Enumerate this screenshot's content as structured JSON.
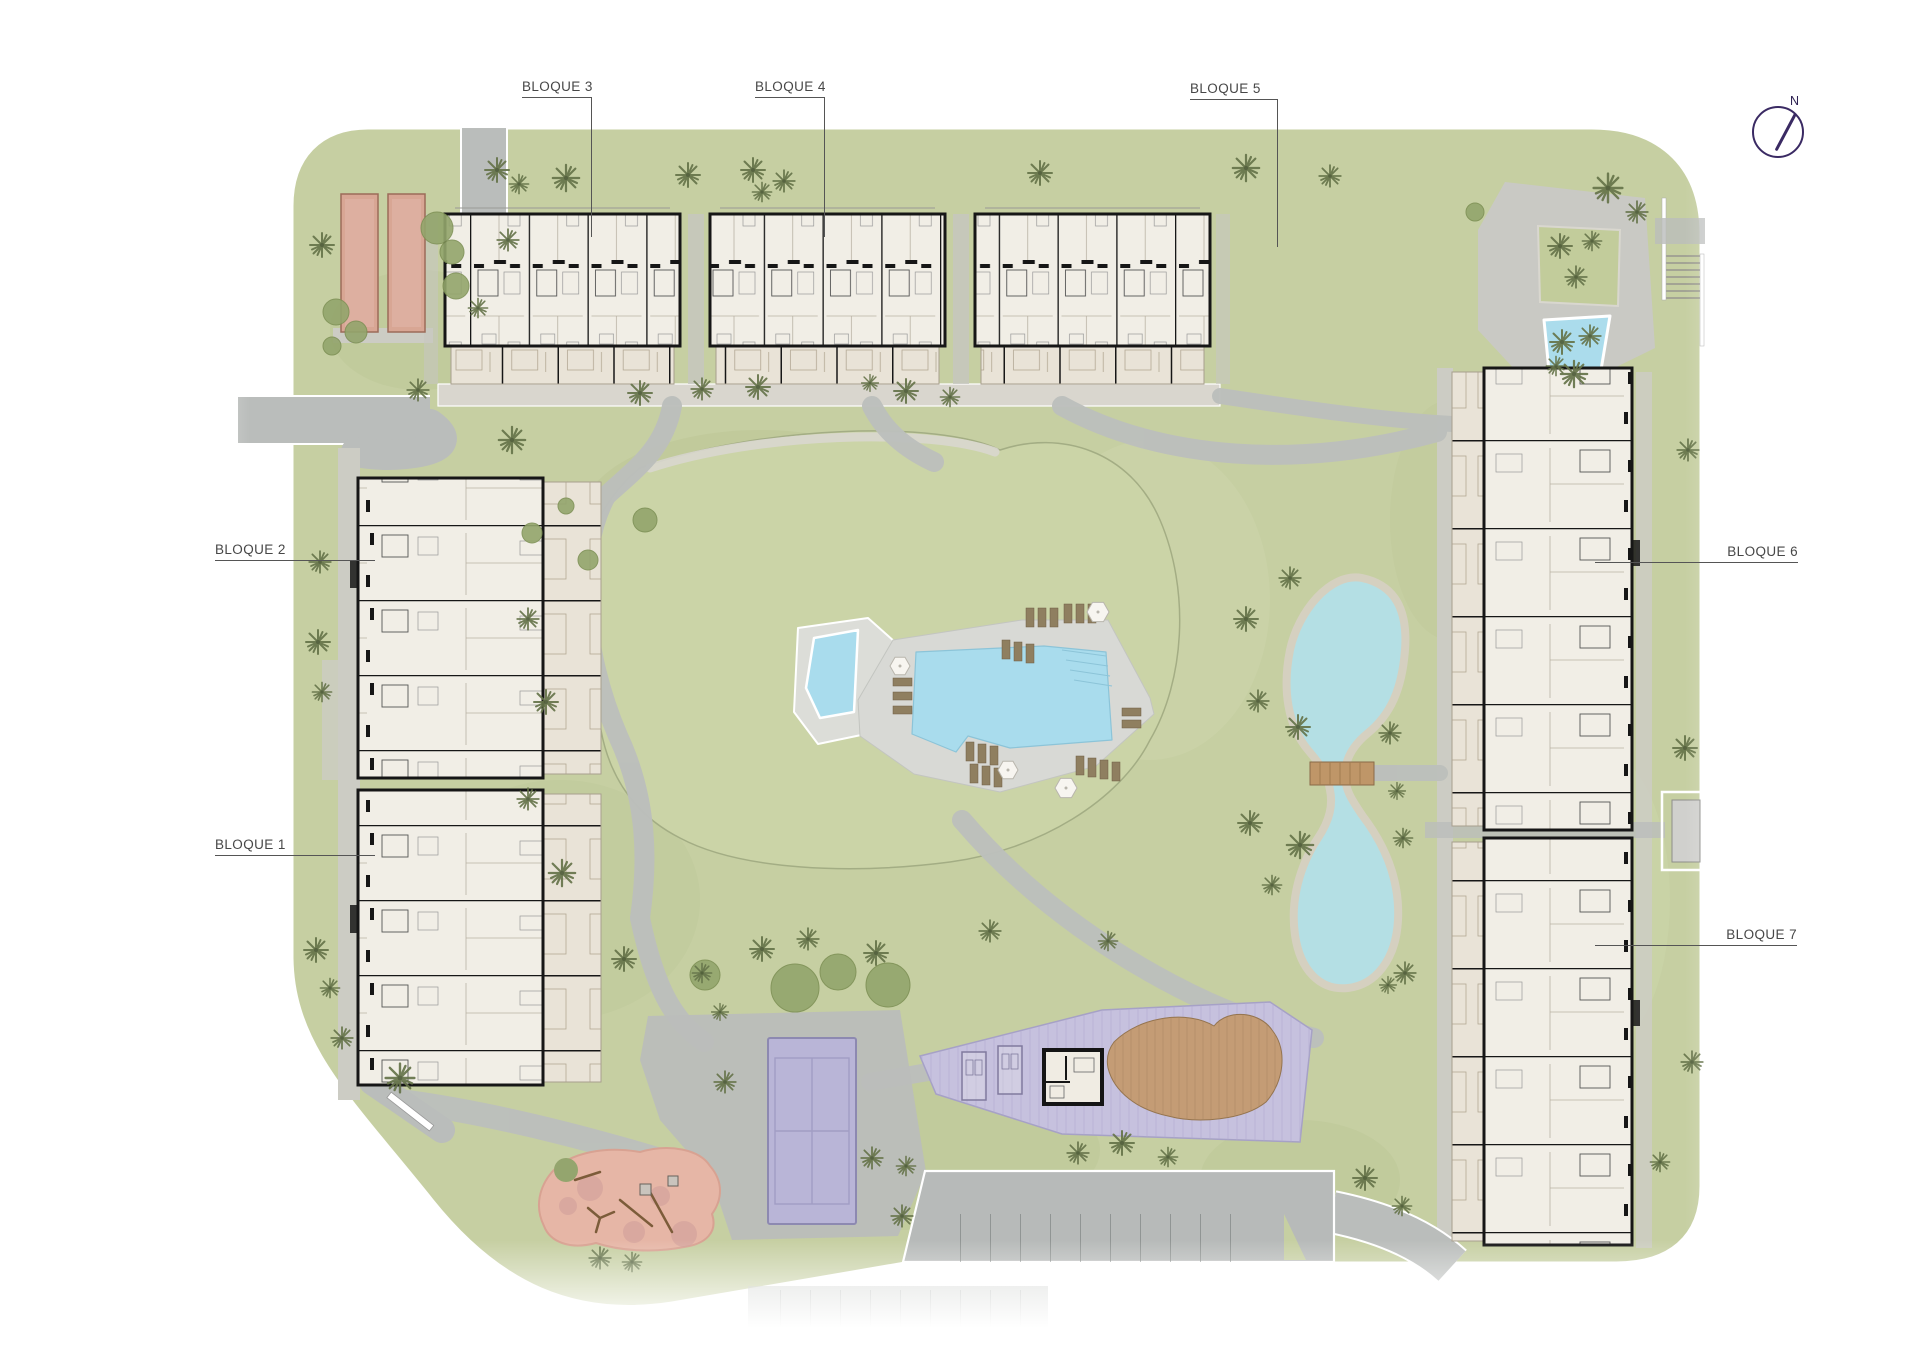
{
  "site_plan": {
    "compass": {
      "label": "N"
    },
    "blocks": [
      {
        "id": "bloque-1",
        "label": "BLOQUE 1"
      },
      {
        "id": "bloque-2",
        "label": "BLOQUE 2"
      },
      {
        "id": "bloque-3",
        "label": "BLOQUE 3"
      },
      {
        "id": "bloque-4",
        "label": "BLOQUE 4"
      },
      {
        "id": "bloque-5",
        "label": "BLOQUE 5"
      },
      {
        "id": "bloque-6",
        "label": "BLOQUE 6"
      },
      {
        "id": "bloque-7",
        "label": "BLOQUE 7"
      }
    ],
    "amenities": [
      "main-pool",
      "kids-pool",
      "entrance-water-feature",
      "natural-lake",
      "wooden-bridge",
      "paddle-tennis-court",
      "community-deck",
      "clubhouse",
      "wooden-lounge-deck",
      "playground",
      "petanque-courts",
      "parking",
      "sun-loungers",
      "umbrellas",
      "pedestrian-gate"
    ],
    "colors": {
      "lawn": "#c6cfa2",
      "road": "#babdbb",
      "paving": "#d9d6ce",
      "gravel": "#ccccc4",
      "building_floor": "#f1eee6",
      "wall": "#161616",
      "terrace": "#e9e3d7",
      "pool": "#a9dced",
      "lake": "#b4dfe4",
      "court": "#b9b5d7",
      "deck_purple": "#c6c1de",
      "wood": "#c49c75",
      "playground": "#e6b6a6",
      "clay_court": "#d8a694",
      "label_text": "#474747",
      "compass": "#3a2a63"
    }
  }
}
